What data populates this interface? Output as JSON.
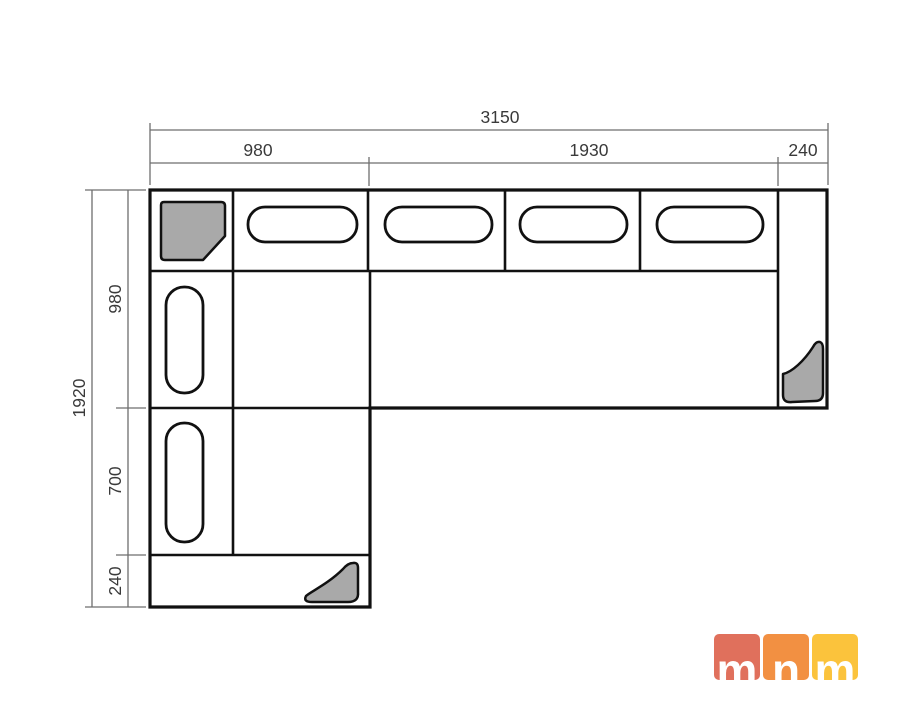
{
  "drawing": {
    "name": "corner-sofa-floor-plan",
    "colors": {
      "outline": "#111111",
      "block_gray": "#a9a9a9",
      "dim_line": "#6e6e6e",
      "dim_text": "#3a3a3a",
      "background": "#ffffff"
    },
    "dims": {
      "top_total": "3150",
      "top_seg_left": "980",
      "top_seg_mid": "1930",
      "top_seg_right": "240",
      "left_total": "1920",
      "left_seg_top": "980",
      "left_seg_mid": "700",
      "left_seg_bottom": "240"
    }
  },
  "logo": {
    "tiles": [
      {
        "letter": "m",
        "color": "#e0705c"
      },
      {
        "letter": "n",
        "color": "#f29042"
      },
      {
        "letter": "m",
        "color": "#fbc33c"
      }
    ]
  }
}
